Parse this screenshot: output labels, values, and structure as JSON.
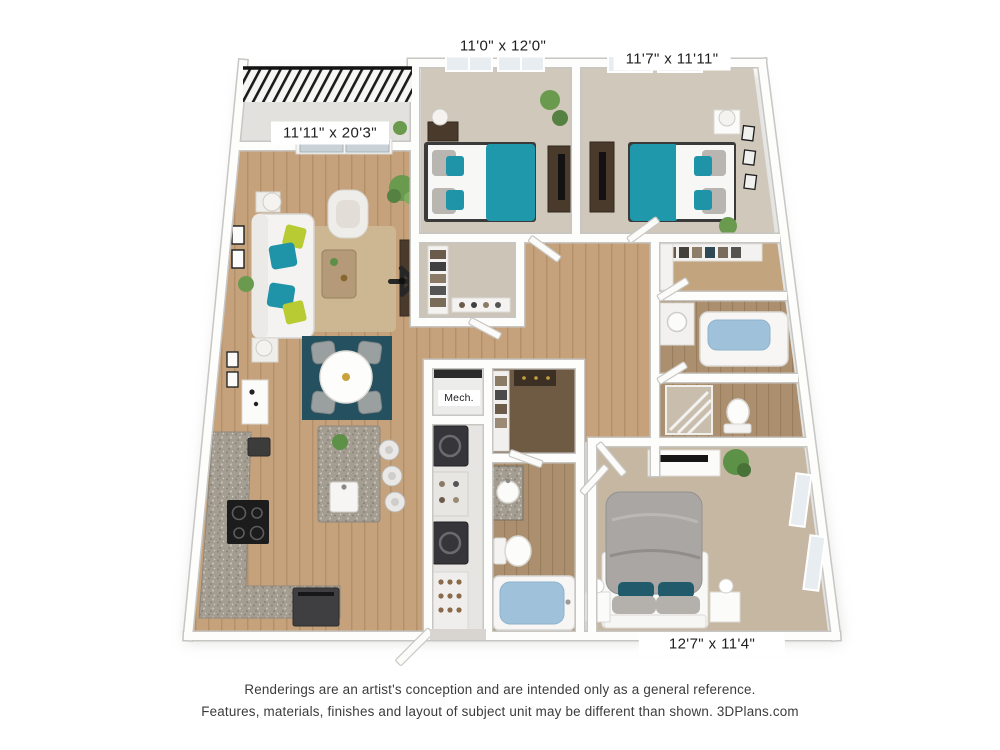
{
  "floor_plan": {
    "room_labels": {
      "living_room": "11'11\" x 20'3\"",
      "bedroom_top_left": "11'0\" x 12'0\"",
      "bedroom_top_right": "11'7\" x 11'11\"",
      "bedroom_master": "12'7\" x 11'4\"",
      "mechanical_closet": "Mech."
    },
    "colors": {
      "accent_teal_bed": "#1f98ac",
      "accent_dark_teal_rug": "#24505f",
      "accent_lime_pillow": "#b8cb32",
      "wood_floor": "#c5a27b",
      "bedroom_carpet": "#cfc8bb",
      "master_carpet": "#c6b7a3",
      "tub_water": "#9fc2da",
      "granite": "#a49d91"
    }
  },
  "footer": {
    "line1": "Renderings are an artist's conception and are intended only as a general reference.",
    "line2": "Features, materials, finishes and layout of subject unit may be different than shown. 3DPlans.com"
  }
}
